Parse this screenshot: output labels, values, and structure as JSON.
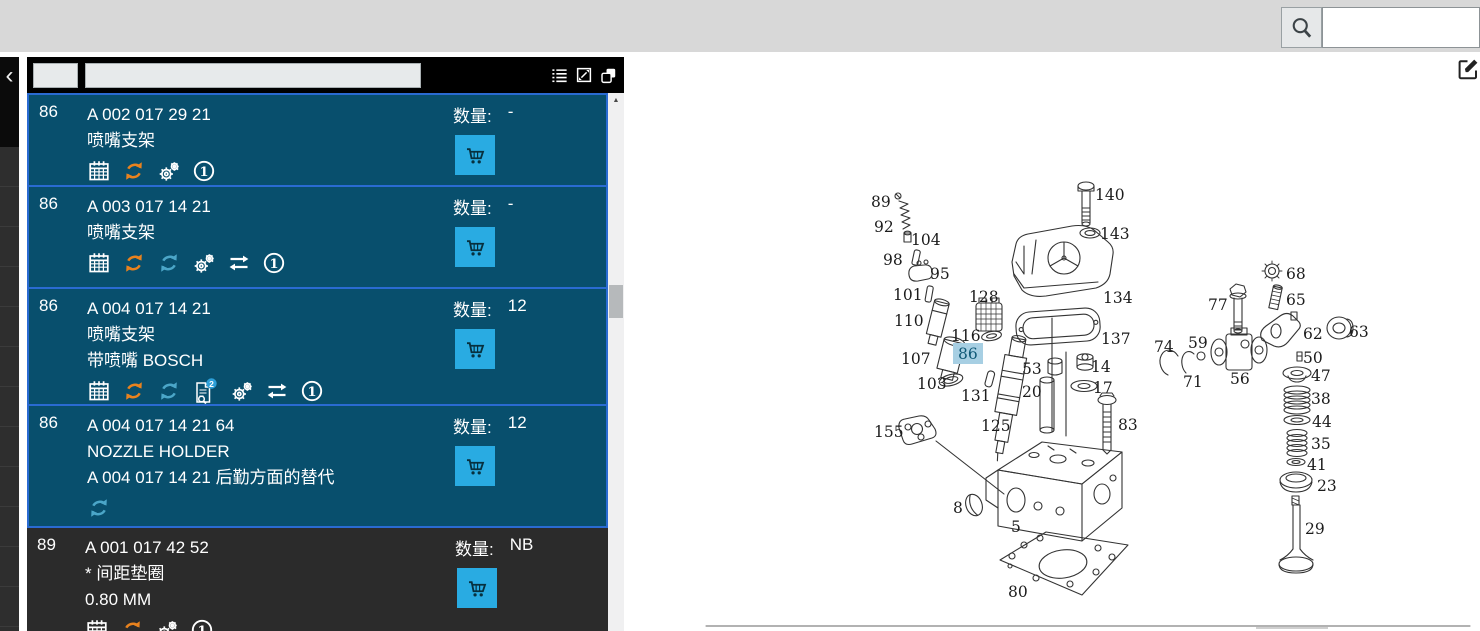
{
  "top_bar": {
    "search_value": "",
    "search_placeholder": ""
  },
  "panel": {
    "header": {
      "field1_value": "",
      "field2_value": "",
      "icons": [
        "list-view-icon",
        "expand-icon",
        "copy-window-icon"
      ]
    },
    "qty_label": "数量:",
    "rows": [
      {
        "pos": "86",
        "code": "A 002 017 29 21",
        "line2": "喷嘴支架",
        "qty": "-",
        "selected": true,
        "icons": [
          "calendar-icon",
          "refresh-orange-icon",
          "gears-icon",
          "footnote-1-icon"
        ]
      },
      {
        "pos": "86",
        "code": "A 003 017 14 21",
        "line2": "喷嘴支架",
        "qty": "-",
        "selected": true,
        "icons": [
          "calendar-icon",
          "refresh-orange-icon",
          "refresh-blue-icon",
          "gears-icon",
          "swap-icon",
          "footnote-1-icon"
        ]
      },
      {
        "pos": "86",
        "code": "A 004 017 14 21",
        "line2": "喷嘴支架",
        "line3": "带喷嘴 BOSCH",
        "qty": "12",
        "selected": true,
        "doc_badge": "2",
        "icons": [
          "calendar-icon",
          "refresh-orange-icon",
          "refresh-blue-icon",
          "document-search-badge-icon",
          "gears-icon",
          "swap-icon",
          "footnote-1-icon"
        ]
      },
      {
        "pos": "86",
        "code": "A 004 017 14 21 64",
        "line2": "NOZZLE HOLDER",
        "line3": "A 004 017 14 21 后勤方面的替代",
        "qty": "12",
        "selected": true,
        "icons": [
          "refresh-blue-icon"
        ]
      },
      {
        "pos": "89",
        "code": "A 001 017 42 52",
        "line2": "* 间距垫圈",
        "line3": "0.80 MM",
        "qty": "NB",
        "selected": false,
        "icons": [
          "calendar-icon",
          "refresh-orange-icon",
          "gears-icon",
          "footnote-1-icon"
        ]
      }
    ]
  },
  "diagram": {
    "highlighted_part": "86",
    "labels": [
      {
        "t": "89",
        "x": 871,
        "y": 207
      },
      {
        "t": "92",
        "x": 874,
        "y": 232
      },
      {
        "t": "104",
        "x": 911,
        "y": 245
      },
      {
        "t": "98",
        "x": 883,
        "y": 265
      },
      {
        "t": "95",
        "x": 930,
        "y": 279
      },
      {
        "t": "101",
        "x": 893,
        "y": 300
      },
      {
        "t": "128",
        "x": 969,
        "y": 302
      },
      {
        "t": "110",
        "x": 894,
        "y": 326
      },
      {
        "t": "116",
        "x": 951,
        "y": 341
      },
      {
        "t": "86",
        "x": 958,
        "y": 359,
        "h": true
      },
      {
        "t": "107",
        "x": 901,
        "y": 364
      },
      {
        "t": "103",
        "x": 917,
        "y": 389
      },
      {
        "t": "131",
        "x": 961,
        "y": 401
      },
      {
        "t": "155",
        "x": 874,
        "y": 437
      },
      {
        "t": "125",
        "x": 981,
        "y": 431
      },
      {
        "t": "53",
        "x": 1022,
        "y": 374
      },
      {
        "t": "20",
        "x": 1022,
        "y": 397
      },
      {
        "t": "14",
        "x": 1091,
        "y": 372
      },
      {
        "t": "17",
        "x": 1093,
        "y": 393
      },
      {
        "t": "83",
        "x": 1118,
        "y": 430
      },
      {
        "t": "8",
        "x": 953,
        "y": 513
      },
      {
        "t": "5",
        "x": 1011,
        "y": 532
      },
      {
        "t": "80",
        "x": 1008,
        "y": 597
      },
      {
        "t": "140",
        "x": 1095,
        "y": 200
      },
      {
        "t": "143",
        "x": 1100,
        "y": 239
      },
      {
        "t": "134",
        "x": 1103,
        "y": 303
      },
      {
        "t": "137",
        "x": 1101,
        "y": 344
      },
      {
        "t": "68",
        "x": 1286,
        "y": 279
      },
      {
        "t": "65",
        "x": 1286,
        "y": 305
      },
      {
        "t": "77",
        "x": 1208,
        "y": 310
      },
      {
        "t": "62",
        "x": 1303,
        "y": 339
      },
      {
        "t": "63",
        "x": 1349,
        "y": 337
      },
      {
        "t": "74",
        "x": 1154,
        "y": 352
      },
      {
        "t": "59",
        "x": 1188,
        "y": 348
      },
      {
        "t": "71",
        "x": 1183,
        "y": 387
      },
      {
        "t": "56",
        "x": 1230,
        "y": 384
      },
      {
        "t": "50",
        "x": 1303,
        "y": 363
      },
      {
        "t": "47",
        "x": 1311,
        "y": 381
      },
      {
        "t": "38",
        "x": 1311,
        "y": 404
      },
      {
        "t": "44",
        "x": 1312,
        "y": 427
      },
      {
        "t": "35",
        "x": 1311,
        "y": 449
      },
      {
        "t": "41",
        "x": 1307,
        "y": 470
      },
      {
        "t": "23",
        "x": 1317,
        "y": 491
      },
      {
        "t": "29",
        "x": 1305,
        "y": 534
      }
    ]
  },
  "rail": {
    "collapse_glyph": "‹"
  },
  "colors": {
    "row_selected": "#084f6d",
    "row_border": "#2a6bd2",
    "row_dark": "#2b2b2b",
    "cart_button": "#29abe2",
    "refresh_orange": "#e8821e",
    "refresh_blue": "#4ba6c8",
    "diagram_highlight_bg": "#a7cfe3",
    "topbar_gray": "#d8d8d8"
  }
}
